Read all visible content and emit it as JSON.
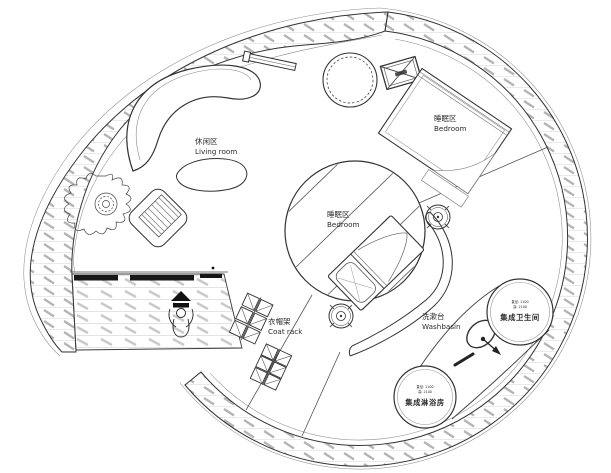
{
  "drawing": {
    "type": "architectural floor plan",
    "shape": "spiral circular tiny-house plan"
  },
  "colors": {
    "background": "#ffffff",
    "line": "#2f2f2f",
    "hatch": "#b4b4b4",
    "door": "#161616"
  },
  "labels": {
    "living_room": {
      "zh": "休闲区",
      "en": "Living room"
    },
    "bedroom_upper": {
      "zh": "睡眠区",
      "en": "Bedroom"
    },
    "bedroom_center": {
      "zh": "睡眠区",
      "en": "Bedroom"
    },
    "coat_rack": {
      "zh": "衣帽架",
      "en": "Coat rack"
    },
    "washbasin": {
      "zh": "洗漱台",
      "en": "Washbasin"
    },
    "bathroom_pod": {
      "spec_line1": "直径: 1100",
      "spec_line2": "高: 2100",
      "name": "集成卫生间"
    },
    "shower_pod": {
      "spec_line1": "直径: 1100",
      "spec_line2": "高: 2100",
      "name": "集成淋浴房"
    }
  }
}
